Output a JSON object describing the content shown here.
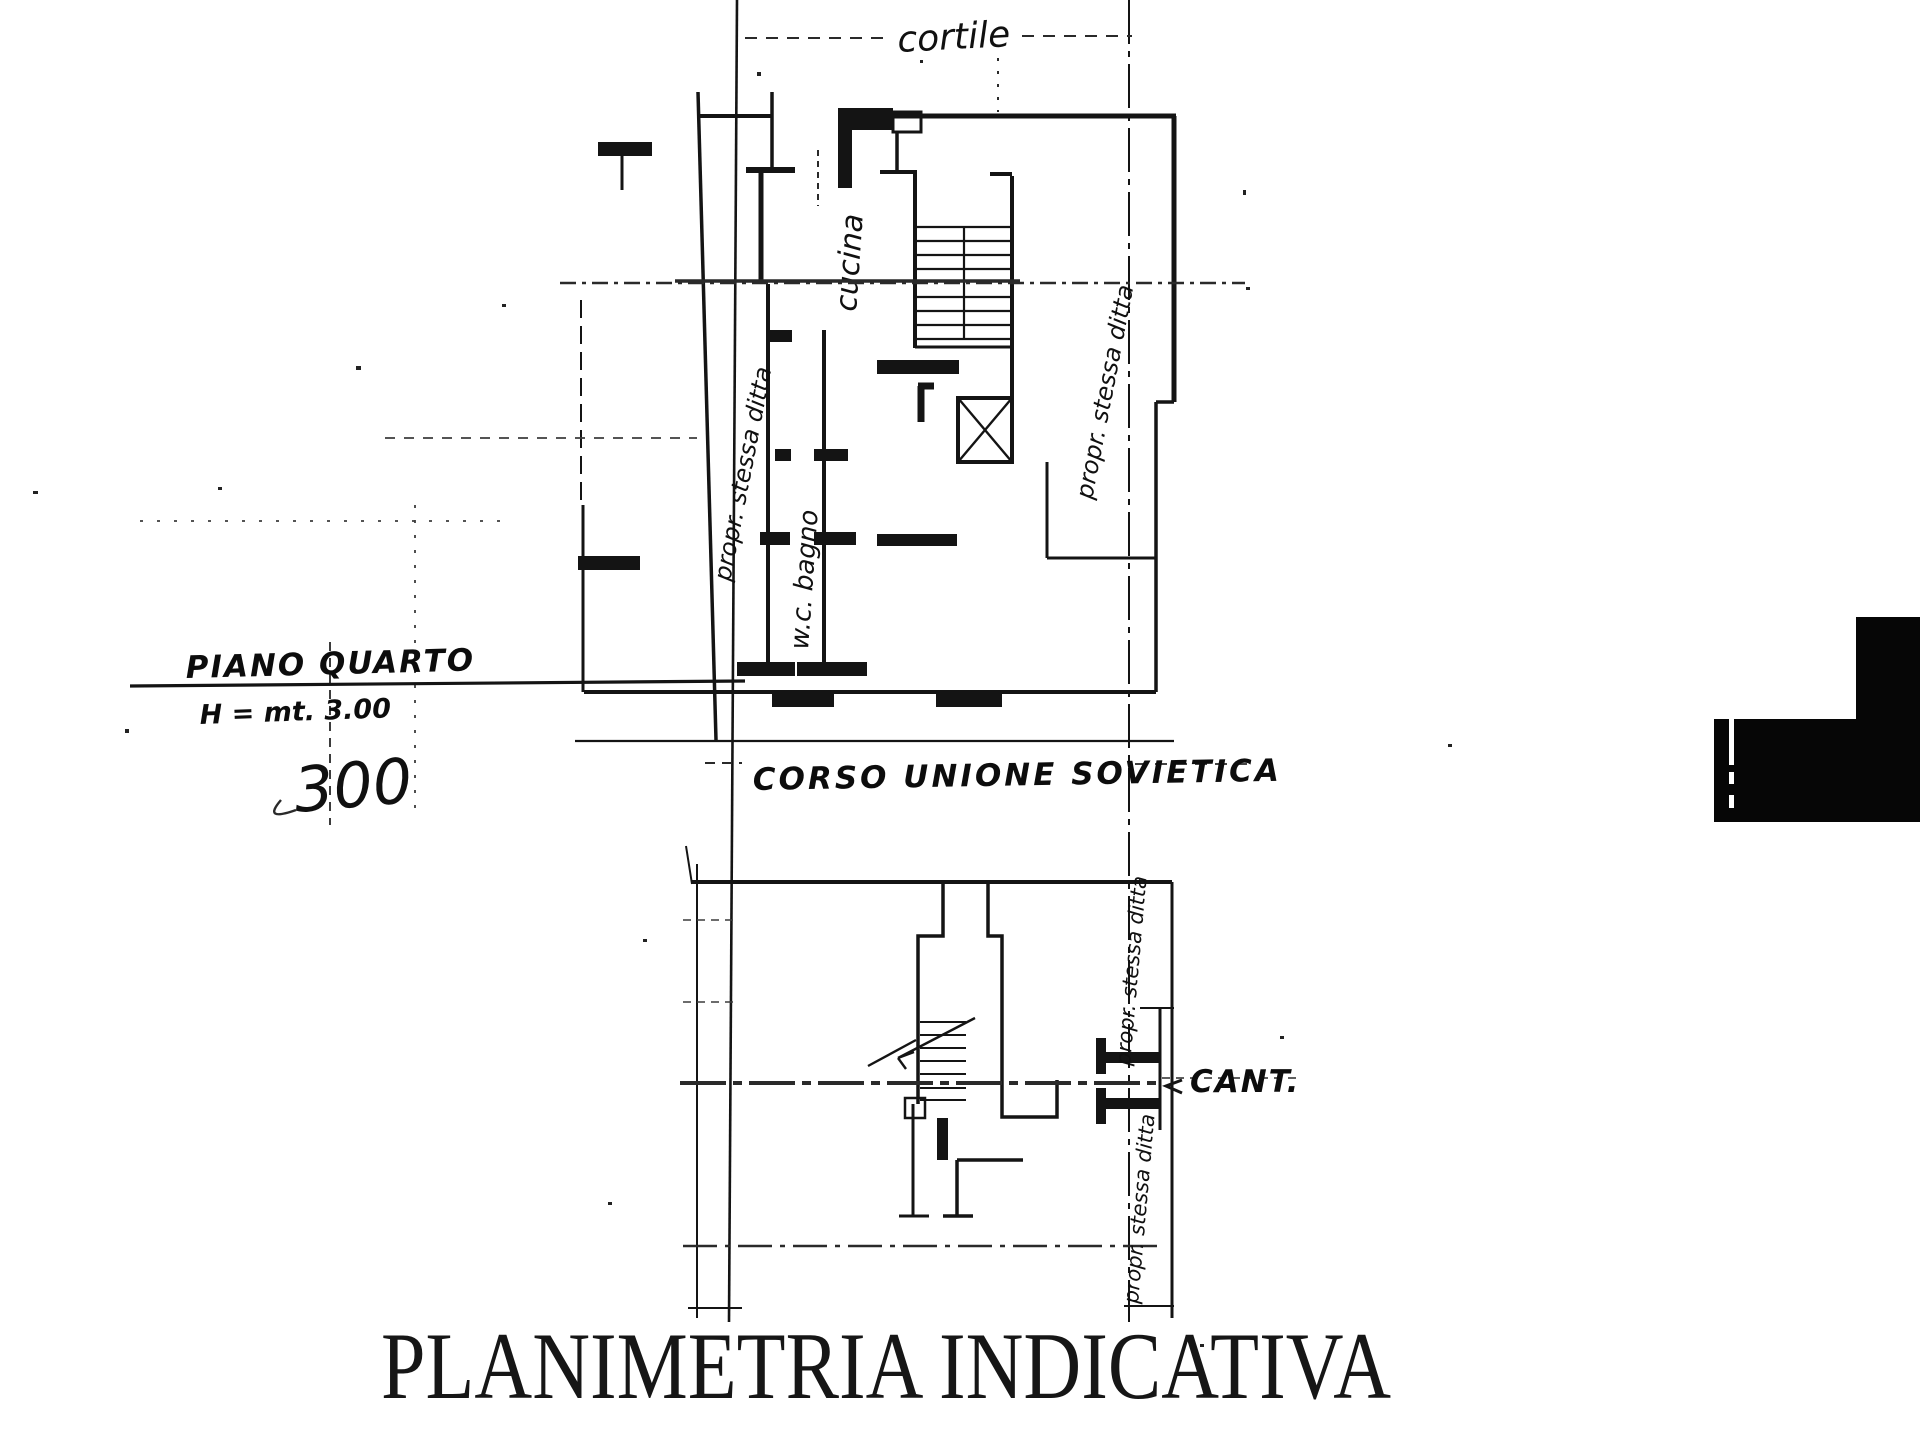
{
  "page": {
    "title": "PLANIMETRIA INDICATIVA"
  },
  "upper_plan": {
    "courtyard": "cortile",
    "kitchen": "cucina",
    "bathroom": "w.c. bagno",
    "left_boundary_note": "propr. stessa ditta",
    "right_boundary_note": "propr. stessa ditta",
    "floor": "PIANO QUARTO",
    "height": "H = mt. 3.00",
    "plan_number": "300"
  },
  "street": {
    "name": "CORSO UNIONE SOVIETICA"
  },
  "lower_plan": {
    "cellar": "CANT.",
    "upper_boundary_note": "propr. stessa ditta",
    "lower_boundary_note": "propr. stessa ditta"
  }
}
